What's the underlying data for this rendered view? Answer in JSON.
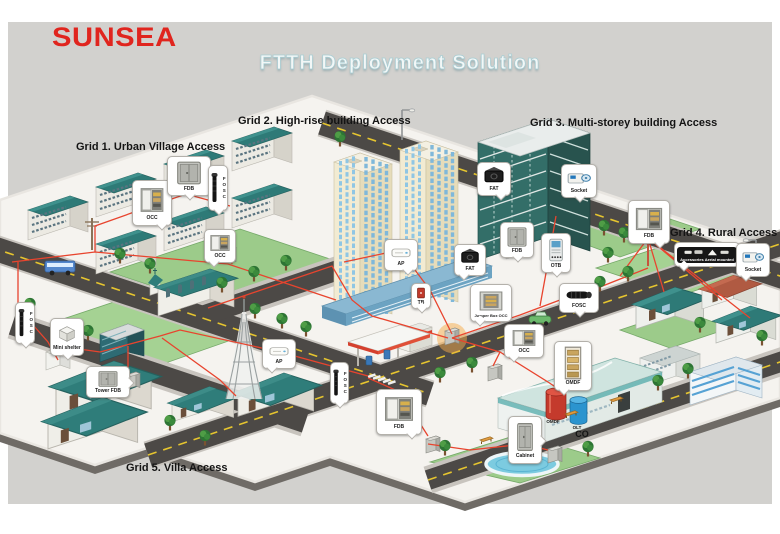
{
  "logo": {
    "text": "SUNSEA"
  },
  "title": {
    "text": "FTTH Deployment Solution"
  },
  "grids": {
    "grid1": {
      "label": "Grid 1. Urban Village Access"
    },
    "grid2": {
      "label": "Grid 2. High-rise building Access"
    },
    "grid3": {
      "label": "Grid 3. Multi-storey building Access"
    },
    "grid4": {
      "label": "Grid 4. Rural Access"
    },
    "grid5": {
      "label": "Grid 5. Villa Access"
    }
  },
  "central_office": {
    "label": "CO",
    "omdf_label": "OMDF",
    "olt_label": "OLT"
  },
  "callouts": {
    "occ_urban_wall": {
      "label": "OCC"
    },
    "fdb_urban": {
      "label": "FDB"
    },
    "fosc_urban": {
      "label": "FOSC"
    },
    "occ_urban_street": {
      "label": "OCC"
    },
    "mini_shelter": {
      "label": "Mini shelter"
    },
    "fosc_left": {
      "label": "FOSC"
    },
    "tower_fdb": {
      "label": "Tower FDB"
    },
    "ap_villa": {
      "label": "AP"
    },
    "fosc_villa": {
      "label": "FOSC"
    },
    "fdb_villa": {
      "label": "FDB"
    },
    "ap_highrise": {
      "label": "AP"
    },
    "tb_highrise": {
      "label": "TB"
    },
    "fat_highrise": {
      "label": "FAT"
    },
    "jumper_box_occ": {
      "label": "Jumper Box OCC"
    },
    "occ_center": {
      "label": "OCC"
    },
    "fat_multistorey": {
      "label": "FAT"
    },
    "socket_multistorey": {
      "label": "Socket"
    },
    "fdb_multistorey": {
      "label": "FDB"
    },
    "otb": {
      "label": "OTB"
    },
    "fosc_road": {
      "label": "FOSC"
    },
    "fdb_rural": {
      "label": "FDB"
    },
    "accessories_aerial": {
      "label": "Accessories Aerial mounted"
    },
    "socket_rural": {
      "label": "Socket"
    },
    "omdf": {
      "label": "OMDF"
    },
    "cabinet": {
      "label": "Cabinet"
    }
  },
  "colors": {
    "brand_red": "#e0251e",
    "cable_red": "#e8442e",
    "roof_teal": "#2e7a77",
    "panel_bg": "#d2d1ce",
    "title_text": "#f2f7f7"
  }
}
